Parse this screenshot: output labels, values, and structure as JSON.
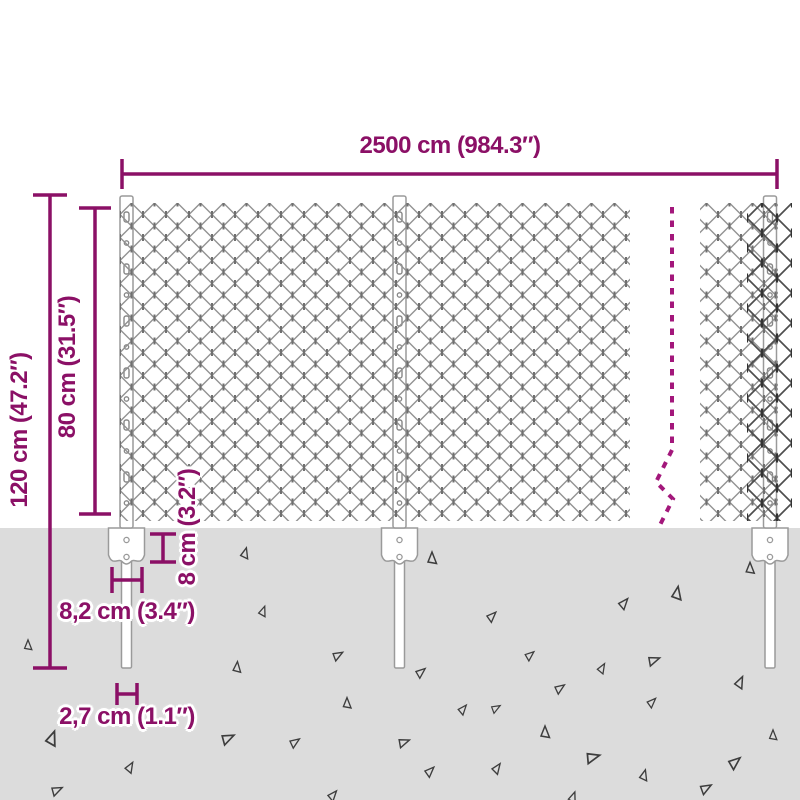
{
  "dimension_labels": {
    "total_width": "2500 cm (984.3″)",
    "total_height": "120 cm (47.2″)",
    "fence_height": "80 cm (31.5″)",
    "bracket_height": "8 cm (3.2″)",
    "bracket_width": "8,2 cm (3.4″)",
    "post_width": "2,7 cm (1.1″)"
  },
  "colors": {
    "dimension_accent": "#8b1066",
    "break_line": "#a3177b",
    "mesh_wire": "#919191",
    "mesh_wire_dark": "#4e4e4e",
    "post_outline": "#9a9a9a",
    "ground": "#dcdcdc",
    "debris_outline": "#3d3d3d",
    "background": "#ffffff"
  }
}
